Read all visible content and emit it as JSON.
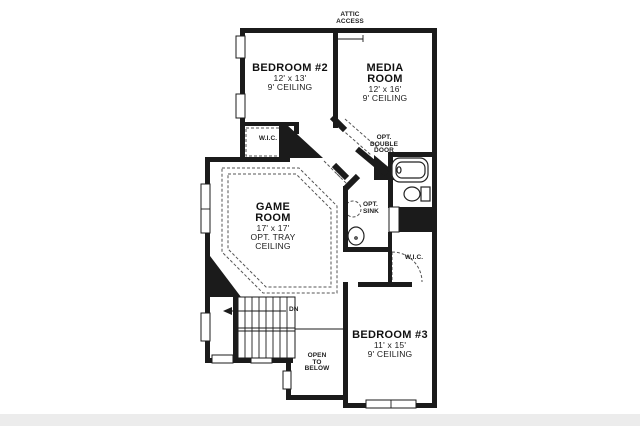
{
  "colors": {
    "wall": "#1b1b1b",
    "dashed_line": "#555555",
    "text": "#111111",
    "bottom_strip": "#ececec"
  },
  "labels": {
    "attic_access": {
      "line1": "ATTIC",
      "line2": "ACCESS"
    },
    "wic_bedroom2": "W.I.C.",
    "wic_bedroom3": "W.I.C.",
    "opt_double_door": {
      "line1": "OPT.",
      "line2": "DOUBLE",
      "line3": "DOOR"
    },
    "opt_sink": {
      "line1": "OPT.",
      "line2": "SINK"
    },
    "stairs_down": "DN",
    "open_to_below": {
      "line1": "OPEN",
      "line2": "TO",
      "line3": "BELOW"
    }
  },
  "rooms": {
    "bedroom2": {
      "name": "BEDROOM #2",
      "dims": "12' x 13'",
      "ceiling": "9' CEILING"
    },
    "media_room": {
      "name_line1": "MEDIA",
      "name_line2": "ROOM",
      "dims": "12' x 16'",
      "ceiling": "9' CEILING"
    },
    "game_room": {
      "name_line1": "GAME",
      "name_line2": "ROOM",
      "dims": "17' x 17'",
      "ceiling_line1": "OPT. TRAY",
      "ceiling_line2": "CEILING"
    },
    "bedroom3": {
      "name": "BEDROOM #3",
      "dims": "11' x 15'",
      "ceiling": "9' CEILING"
    }
  }
}
